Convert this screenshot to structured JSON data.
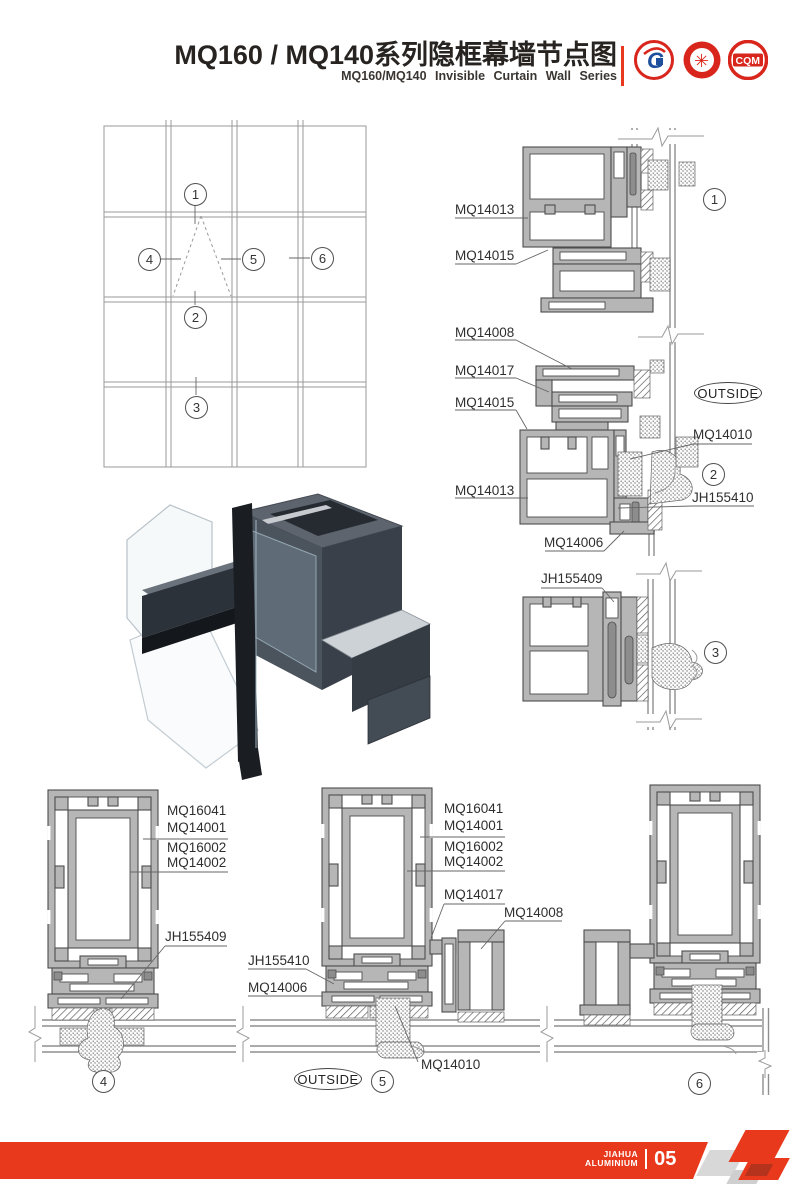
{
  "header": {
    "title": "MQ160 / MQ140系列隐框幕墙节点图",
    "subtitle": "MQ160/MQ140  Invisible  Curtain  Wall  Series",
    "logos": {
      "g_mark": "G",
      "seal_glyph": "✳",
      "cqm_text": "CQM"
    }
  },
  "elevation": {
    "markers": {
      "m1": "1",
      "m2": "2",
      "m3": "3",
      "m4": "4",
      "m5": "5",
      "m6": "6"
    }
  },
  "sections": {
    "outside_label": "OUTSIDE",
    "d1": {
      "number": "1",
      "mq14013": "MQ14013",
      "mq14015": "MQ14015"
    },
    "d2": {
      "number": "2",
      "mq14008": "MQ14008",
      "mq14017": "MQ14017",
      "mq14015": "MQ14015",
      "mq14013": "MQ14013",
      "mq14010": "MQ14010",
      "jh155410": "JH155410",
      "mq14006": "MQ14006"
    },
    "d3": {
      "number": "3",
      "jh155409": "JH155409"
    },
    "d4": {
      "number": "4",
      "mq16041": "MQ16041",
      "mq14001": "MQ14001",
      "mq16002": "MQ16002",
      "mq14002": "MQ14002",
      "jh155409": "JH155409"
    },
    "d5": {
      "number": "5",
      "mq16041": "MQ16041",
      "mq14001": "MQ14001",
      "mq16002": "MQ16002",
      "mq14002": "MQ14002",
      "mq14017": "MQ14017",
      "mq14008": "MQ14008",
      "jh155410": "JH155410",
      "mq14006": "MQ14006",
      "mq14010": "MQ14010"
    },
    "d6": {
      "number": "6"
    }
  },
  "footer": {
    "brand_top": "JIAHUA",
    "brand_bottom": "ALUMINIUM",
    "page_number": "05"
  },
  "colors": {
    "accent_red": "#e8391d",
    "profile_fill": "#b6b6b6",
    "line_color": "#4d4d4d"
  }
}
